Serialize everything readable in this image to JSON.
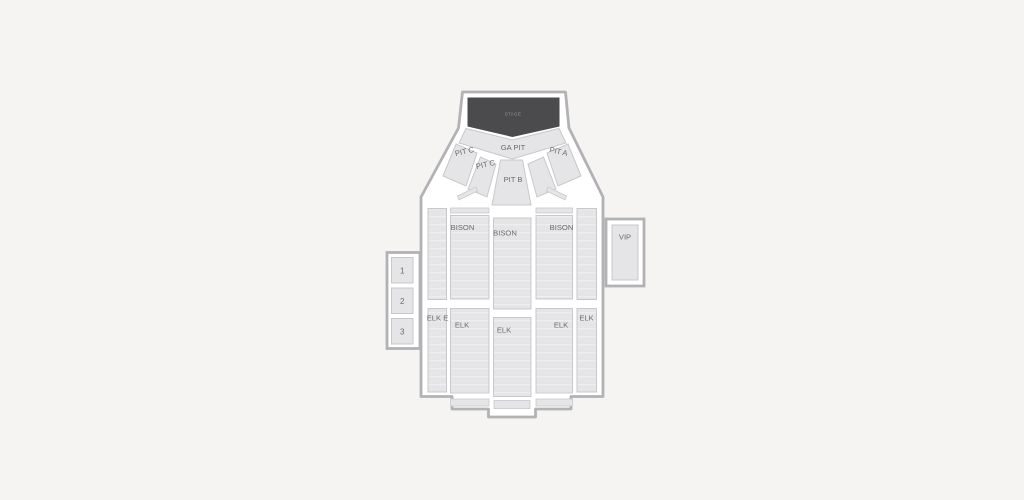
{
  "colors": {
    "background": "#f5f4f2",
    "venue_fill": "#ffffff",
    "outline_stroke": "#b2b2b5",
    "section_fill": "#e5e5e7",
    "section_border": "#c8c8cb",
    "stage_fill": "#4b4b4d",
    "stage_text": "#96969a",
    "label_text": "#6a6a6e"
  },
  "map": {
    "stage": {
      "label": "STAGE"
    },
    "pits": {
      "ga_pit": "GA PIT",
      "pit_c_outer": "PIT C",
      "pit_c_inner": "PIT C",
      "pit_a": "PIT A",
      "pit_b": "PIT B"
    },
    "sections": {
      "bison_left": "BISON",
      "bison_center": "BISON",
      "bison_right": "BISON",
      "elk_far_left": "ELK E",
      "elk_left": "ELK",
      "elk_center": "ELK",
      "elk_right": "ELK",
      "elk_far_right": "ELK",
      "vip": "VIP"
    },
    "boxes": [
      "1",
      "2",
      "3"
    ]
  }
}
